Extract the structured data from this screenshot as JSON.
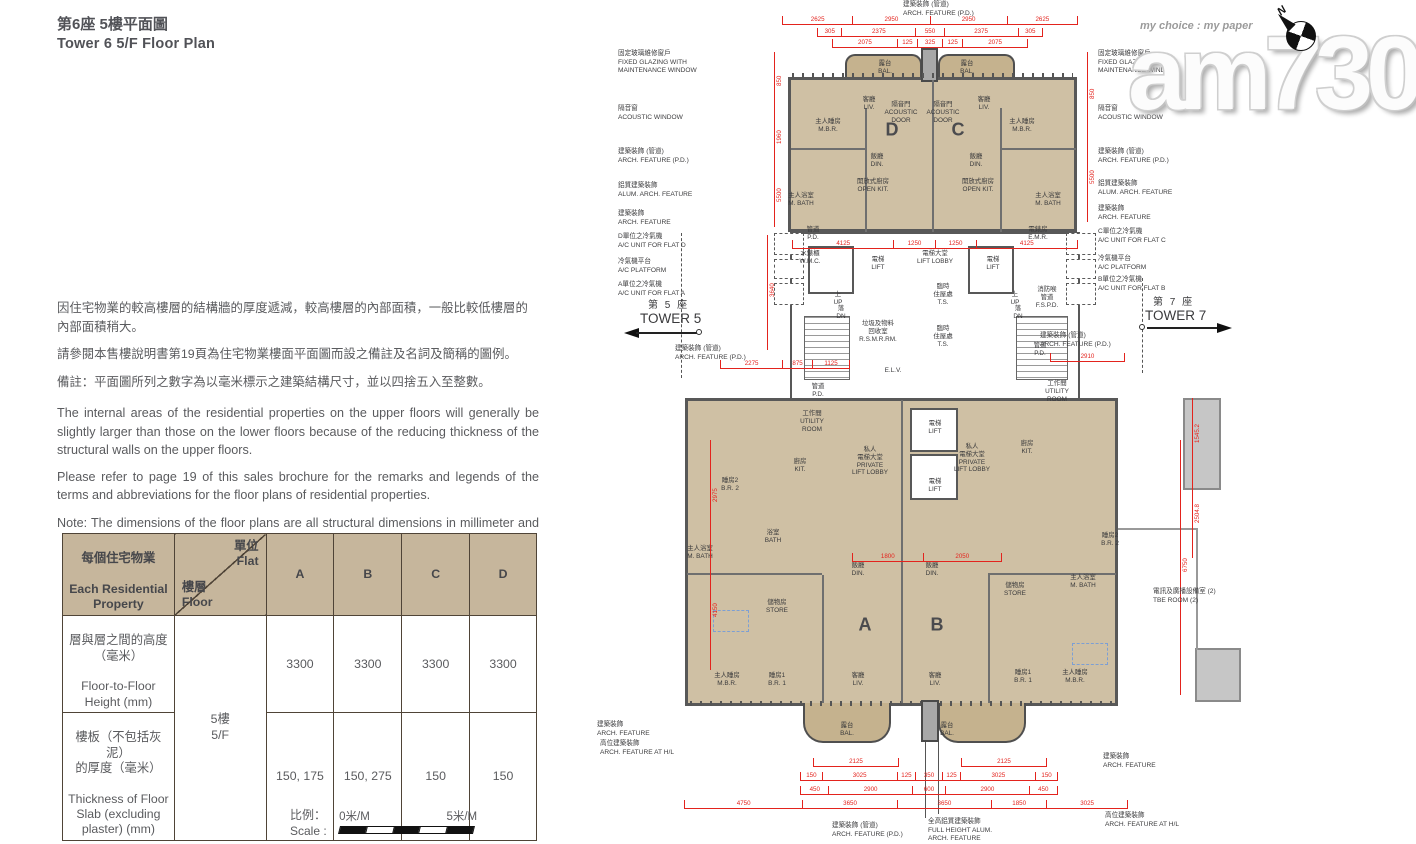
{
  "page": {
    "title_zh": "第6座 5樓平面圖",
    "title_en": "Tower 6 5/F Floor Plan"
  },
  "colors": {
    "dimension_red": "#e3231d",
    "room_tan": "#cfc0a4",
    "balcony_tan": "#c5b28e",
    "table_header_tan": "#c6b69c"
  },
  "notes": {
    "zh": [
      "因住宅物業的較高樓層的結構牆的厚度遞減，較高樓層的內部面積，一般比較低樓層的內部面積稍大。",
      "請參閱本售樓說明書第19頁為住宅物業樓面平面圖而設之備註及名詞及簡稱的圖例。",
      "備註：平面圖所列之數字為以毫米標示之建築結構尺寸，並以四捨五入至整數。"
    ],
    "en": [
      "The internal areas of the residential properties on the upper floors will generally be slightly larger than those on the lower floors because of the reducing thickness of the structural walls on the upper floors.",
      "Please refer to page 19 of this sales brochure for the remarks and legends of the terms and abbreviations for the floor plans of residential properties.",
      "Note: The dimensions of the floor plans are all structural dimensions in millimeter and rounded off to the nearest integer."
    ]
  },
  "table": {
    "corner_zh": "每個住宅物業",
    "corner_en": "Each Residential\nProperty",
    "flat_label": "單位\nFlat",
    "floor_label": "樓層\nFloor",
    "flats": [
      "A",
      "B",
      "C",
      "D"
    ],
    "floor_value": "5樓\n5/F",
    "rows": [
      {
        "label_zh": "層與層之間的高度\n（毫米）",
        "label_en": "Floor-to-Floor\nHeight (mm)",
        "values": [
          "3300",
          "3300",
          "3300",
          "3300"
        ]
      },
      {
        "label_zh": "樓板（不包括灰泥）\n的厚度（毫米）",
        "label_en": "Thickness of Floor\nSlab (excluding\nplaster) (mm)",
        "values": [
          "150, 175",
          "150, 275",
          "150",
          "150"
        ]
      }
    ]
  },
  "scale_bar": {
    "label_zh": "比例：",
    "label_en": "Scale :",
    "start": "0米/M",
    "end": "5米/M"
  },
  "watermark": {
    "logo": "am730",
    "tagline": "my choice : my paper"
  },
  "compass": {
    "label": "N"
  },
  "plan": {
    "tower5": {
      "zh": "第 5 座",
      "en": "TOWER 5"
    },
    "tower7": {
      "zh": "第 7 座",
      "en": "TOWER 7"
    },
    "units": [
      {
        "label": "D",
        "x": 322,
        "y": 130
      },
      {
        "label": "C",
        "x": 388,
        "y": 130
      },
      {
        "label": "A",
        "x": 295,
        "y": 625
      },
      {
        "label": "B",
        "x": 367,
        "y": 625
      }
    ],
    "rooms": [
      {
        "x": 315,
        "y": 60,
        "zh": "露台",
        "en": "BAL."
      },
      {
        "x": 397,
        "y": 60,
        "zh": "露台",
        "en": "BAL."
      },
      {
        "x": 299,
        "y": 96,
        "zh": "客廳",
        "en": "LIV."
      },
      {
        "x": 331,
        "y": 101,
        "zh": "隔音門",
        "en": "ACOUSTIC\nDOOR"
      },
      {
        "x": 373,
        "y": 101,
        "zh": "隔音門",
        "en": "ACOUSTIC\nDOOR"
      },
      {
        "x": 414,
        "y": 96,
        "zh": "客廳",
        "en": "LIV."
      },
      {
        "x": 258,
        "y": 118,
        "zh": "主人睡房",
        "en": "M.B.R."
      },
      {
        "x": 452,
        "y": 118,
        "zh": "主人睡房",
        "en": "M.B.R."
      },
      {
        "x": 307,
        "y": 153,
        "zh": "飯廳",
        "en": "DIN."
      },
      {
        "x": 406,
        "y": 153,
        "zh": "飯廳",
        "en": "DIN."
      },
      {
        "x": 303,
        "y": 178,
        "zh": "開放式廚房",
        "en": "OPEN KIT."
      },
      {
        "x": 408,
        "y": 178,
        "zh": "開放式廚房",
        "en": "OPEN KIT."
      },
      {
        "x": 231,
        "y": 192,
        "zh": "主人浴室",
        "en": "M. BATH"
      },
      {
        "x": 478,
        "y": 192,
        "zh": "主人浴室",
        "en": "M. BATH"
      },
      {
        "x": 243,
        "y": 226,
        "zh": "管道",
        "en": "P.D."
      },
      {
        "x": 240,
        "y": 250,
        "zh": "水錶櫃",
        "en": "W.M.C."
      },
      {
        "x": 468,
        "y": 226,
        "zh": "電錶房",
        "en": "E.M.R."
      },
      {
        "x": 308,
        "y": 256,
        "zh": "電梯",
        "en": "LIFT"
      },
      {
        "x": 423,
        "y": 256,
        "zh": "電梯",
        "en": "LIFT"
      },
      {
        "x": 365,
        "y": 250,
        "zh": "電梯大堂",
        "en": "LIFT LOBBY"
      },
      {
        "x": 268,
        "y": 291,
        "zh": "上",
        "en": "UP"
      },
      {
        "x": 271,
        "y": 305,
        "zh": "落",
        "en": "DN"
      },
      {
        "x": 445,
        "y": 291,
        "zh": "上",
        "en": "UP"
      },
      {
        "x": 448,
        "y": 305,
        "zh": "落",
        "en": "DN"
      },
      {
        "x": 308,
        "y": 320,
        "zh": "垃圾及物料\n回收室",
        "en": "R.S.M.R.RM."
      },
      {
        "x": 373,
        "y": 283,
        "zh": "臨時\n住屋處",
        "en": "T.S."
      },
      {
        "x": 373,
        "y": 325,
        "zh": "臨時\n住屋處",
        "en": "T.S."
      },
      {
        "x": 477,
        "y": 286,
        "zh": "消防喉\n管道",
        "en": "F.S.P.D."
      },
      {
        "x": 470,
        "y": 342,
        "zh": "管道",
        "en": "P.D."
      },
      {
        "x": 323,
        "y": 367,
        "zh": "",
        "en": "E.L.V."
      },
      {
        "x": 248,
        "y": 383,
        "zh": "管道",
        "en": "P.D."
      },
      {
        "x": 365,
        "y": 420,
        "zh": "電梯",
        "en": "LIFT"
      },
      {
        "x": 365,
        "y": 478,
        "zh": "電梯",
        "en": "LIFT"
      },
      {
        "x": 300,
        "y": 446,
        "zh": "私人\n電梯大堂",
        "en": "PRIVATE\nLIFT LOBBY"
      },
      {
        "x": 402,
        "y": 443,
        "zh": "私人\n電梯大堂",
        "en": "PRIVATE\nLIFT LOBBY"
      },
      {
        "x": 457,
        "y": 440,
        "zh": "廚房",
        "en": "KIT."
      },
      {
        "x": 242,
        "y": 410,
        "zh": "工作間",
        "en": "UTILITY\nROOM"
      },
      {
        "x": 487,
        "y": 380,
        "zh": "工作間",
        "en": "UTILITY\nROOM"
      },
      {
        "x": 230,
        "y": 458,
        "zh": "廚房",
        "en": "KIT."
      },
      {
        "x": 160,
        "y": 477,
        "zh": "睡房2",
        "en": "B.R. 2"
      },
      {
        "x": 203,
        "y": 529,
        "zh": "浴室",
        "en": "BATH"
      },
      {
        "x": 130,
        "y": 545,
        "zh": "主人浴室",
        "en": "M. BATH"
      },
      {
        "x": 207,
        "y": 599,
        "zh": "儲物房",
        "en": "STORE"
      },
      {
        "x": 288,
        "y": 562,
        "zh": "飯廳",
        "en": "DIN."
      },
      {
        "x": 362,
        "y": 562,
        "zh": "飯廳",
        "en": "DIN."
      },
      {
        "x": 157,
        "y": 672,
        "zh": "主人睡房",
        "en": "M.B.R."
      },
      {
        "x": 207,
        "y": 672,
        "zh": "睡房1",
        "en": "B.R. 1"
      },
      {
        "x": 288,
        "y": 672,
        "zh": "客廳",
        "en": "LIV."
      },
      {
        "x": 365,
        "y": 672,
        "zh": "客廳",
        "en": "LIV."
      },
      {
        "x": 540,
        "y": 532,
        "zh": "睡房2",
        "en": "B.R. 2"
      },
      {
        "x": 445,
        "y": 582,
        "zh": "儲物房",
        "en": "STORE"
      },
      {
        "x": 513,
        "y": 574,
        "zh": "主人浴室",
        "en": "M. BATH"
      },
      {
        "x": 453,
        "y": 669,
        "zh": "睡房1",
        "en": "B.R. 1"
      },
      {
        "x": 505,
        "y": 669,
        "zh": "主人睡房",
        "en": "M.B.R."
      },
      {
        "x": 277,
        "y": 722,
        "zh": "露台",
        "en": "BAL."
      },
      {
        "x": 377,
        "y": 722,
        "zh": "露台",
        "en": "BAL."
      }
    ],
    "callouts": [
      {
        "x": 48,
        "y": 50,
        "t": "固定玻璃維修窗戶\nFIXED GLAZING WITH\nMAINTENANCE WINDOW"
      },
      {
        "x": 48,
        "y": 105,
        "t": "隔音窗\nACOUSTIC WINDOW"
      },
      {
        "x": 48,
        "y": 148,
        "t": "建築裝飾 (管道)\nARCH. FEATURE (P.D.)"
      },
      {
        "x": 48,
        "y": 182,
        "t": "鋁質建築裝飾\nALUM. ARCH. FEATURE"
      },
      {
        "x": 48,
        "y": 210,
        "t": "建築裝飾\nARCH. FEATURE"
      },
      {
        "x": 48,
        "y": 233,
        "t": "D單位之冷氣機\nA/C UNIT FOR FLAT D"
      },
      {
        "x": 48,
        "y": 258,
        "t": "冷氣機平台\nA/C PLATFORM"
      },
      {
        "x": 48,
        "y": 281,
        "t": "A單位之冷氣機\nA/C UNIT FOR FLAT A"
      },
      {
        "x": 105,
        "y": 345,
        "t": "建築裝飾 (管道)\nARCH. FEATURE (P.D.)"
      },
      {
        "x": 27,
        "y": 721,
        "t": "建築裝飾\nARCH. FEATURE"
      },
      {
        "x": 30,
        "y": 740,
        "t": "高位建築裝飾\nARCH. FEATURE AT H/L"
      },
      {
        "x": 528,
        "y": 50,
        "t": "固定玻璃維修窗戶\nFIXED GLAZING WITH\nMAINTENANCE WINDOW"
      },
      {
        "x": 528,
        "y": 105,
        "t": "隔音窗\nACOUSTIC WINDOW"
      },
      {
        "x": 528,
        "y": 148,
        "t": "建築裝飾 (管道)\nARCH. FEATURE (P.D.)"
      },
      {
        "x": 528,
        "y": 180,
        "t": "鋁質建築裝飾\nALUM. ARCH. FEATURE"
      },
      {
        "x": 528,
        "y": 205,
        "t": "建築裝飾\nARCH. FEATURE"
      },
      {
        "x": 528,
        "y": 228,
        "t": "C單位之冷氣機\nA/C UNIT FOR FLAT C"
      },
      {
        "x": 528,
        "y": 255,
        "t": "冷氣機平台\nA/C PLATFORM"
      },
      {
        "x": 528,
        "y": 276,
        "t": "B單位之冷氣機\nA/C UNIT FOR FLAT B"
      },
      {
        "x": 470,
        "y": 332,
        "t": "建築裝飾 (管道)\nARCH. FEATURE (P.D.)"
      },
      {
        "x": 583,
        "y": 588,
        "t": "電訊及廣播設備室 (2)\nTBE ROOM (2)"
      },
      {
        "x": 533,
        "y": 753,
        "t": "建築裝飾\nARCH. FEATURE"
      },
      {
        "x": 535,
        "y": 812,
        "t": "高位建築裝飾\nARCH. FEATURE AT H/L"
      },
      {
        "x": 333,
        "y": 1,
        "t": "建築裝飾 (管道)\nARCH. FEATURE (P.D.)"
      },
      {
        "x": 262,
        "y": 822,
        "t": "建築裝飾 (管道)\nARCH. FEATURE (P.D.)"
      },
      {
        "x": 358,
        "y": 818,
        "t": "全高鋁質建築裝飾\nFULL HEIGHT ALUM.\nARCH. FEATURE"
      }
    ],
    "dim_rows": [
      {
        "x": 212,
        "y": 16,
        "w": 296,
        "values": [
          "2625",
          "2950",
          "2950",
          "2625"
        ]
      },
      {
        "x": 247,
        "y": 28,
        "w": 226,
        "values": [
          "305",
          "2375",
          "550",
          "2375",
          "305"
        ],
        "weights": [
          1,
          4.5,
          1.3,
          4.5,
          1
        ]
      },
      {
        "x": 262,
        "y": 39,
        "w": 196,
        "values": [
          "2075",
          "125",
          "325",
          "125",
          "2075"
        ],
        "weights": [
          4,
          0.7,
          1.1,
          0.7,
          4
        ]
      },
      {
        "x": 222,
        "y": 240,
        "w": 286,
        "values": [
          "4125",
          "1250",
          "1250",
          "4125"
        ]
      },
      {
        "x": 282,
        "y": 553,
        "w": 150,
        "values": [
          "1800",
          "2050"
        ]
      },
      {
        "x": 243,
        "y": 758,
        "w": 86,
        "values": [
          "2125"
        ]
      },
      {
        "x": 391,
        "y": 758,
        "w": 86,
        "values": [
          "2125"
        ]
      },
      {
        "x": 230,
        "y": 772,
        "w": 258,
        "values": [
          "150",
          "3025",
          "125",
          "350",
          "125",
          "3025",
          "150"
        ],
        "weights": [
          0.7,
          4,
          0.5,
          1,
          0.5,
          4,
          0.7
        ]
      },
      {
        "x": 230,
        "y": 786,
        "w": 258,
        "values": [
          "450",
          "2900",
          "600",
          "2900",
          "450"
        ],
        "weights": [
          1,
          4,
          1.3,
          4,
          1
        ]
      },
      {
        "x": 114,
        "y": 800,
        "w": 444,
        "values": [
          "4750",
          "3650",
          "3650",
          "1850",
          "3025"
        ]
      },
      {
        "x": 150,
        "y": 360,
        "w": 130,
        "values": [
          "2275",
          "875",
          "1125"
        ],
        "weights": [
          2.3,
          0.9,
          1.1
        ]
      },
      {
        "x": 480,
        "y": 353,
        "w": 75,
        "values": [
          "2910"
        ]
      }
    ],
    "vdims": [
      {
        "x": 204,
        "y": 52,
        "h": 175,
        "values": [
          "850",
          "1960",
          "5500"
        ]
      },
      {
        "x": 197,
        "y": 235,
        "h": 115,
        "values": [
          "3640"
        ]
      },
      {
        "x": 517,
        "y": 52,
        "h": 170,
        "values": [
          "850",
          "5500"
        ]
      },
      {
        "x": 622,
        "y": 398,
        "h": 160,
        "values": [
          "1545.2",
          "2504.8"
        ]
      },
      {
        "x": 610,
        "y": 440,
        "h": 255,
        "values": [
          "6750"
        ]
      },
      {
        "x": 140,
        "y": 440,
        "h": 230,
        "values": [
          "2975",
          "4150"
        ]
      }
    ],
    "dashed_boxes": [
      {
        "x": 204,
        "y": 233,
        "w": 30,
        "h": 22
      },
      {
        "x": 204,
        "y": 259,
        "w": 30,
        "h": 20
      },
      {
        "x": 204,
        "y": 283,
        "w": 30,
        "h": 22
      },
      {
        "x": 496,
        "y": 233,
        "w": 30,
        "h": 22
      },
      {
        "x": 496,
        "y": 259,
        "w": 30,
        "h": 20
      },
      {
        "x": 496,
        "y": 283,
        "w": 30,
        "h": 22
      }
    ],
    "blue_boxes": [
      {
        "x": 143,
        "y": 610,
        "w": 36,
        "h": 22
      },
      {
        "x": 502,
        "y": 643,
        "w": 36,
        "h": 22
      }
    ]
  }
}
